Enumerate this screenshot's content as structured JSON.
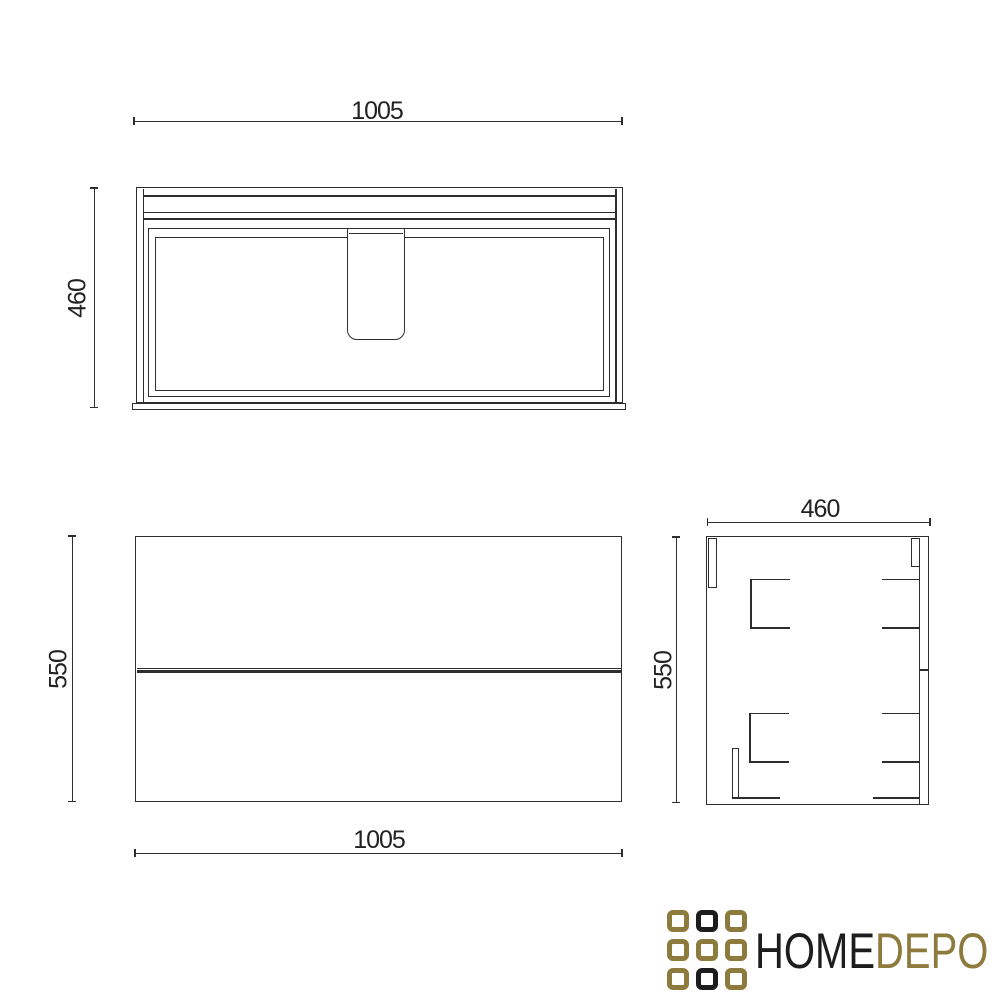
{
  "colors": {
    "ink": "#2e2e2e",
    "background": "#ffffff"
  },
  "dimensions": {
    "plan_width": "1005",
    "plan_depth": "460",
    "front_width": "1005",
    "front_height": "550",
    "side_depth": "460",
    "side_height": "550"
  },
  "logo": {
    "text_primary": "HOME",
    "text_secondary": "DEPO",
    "colors": {
      "primary": "#1d1d1d",
      "gold": "#8d7b3d"
    },
    "grid": [
      [
        "gold",
        "primary",
        "gold"
      ],
      [
        "gold",
        "gold",
        "gold"
      ],
      [
        "gold",
        "primary",
        "gold"
      ]
    ]
  }
}
